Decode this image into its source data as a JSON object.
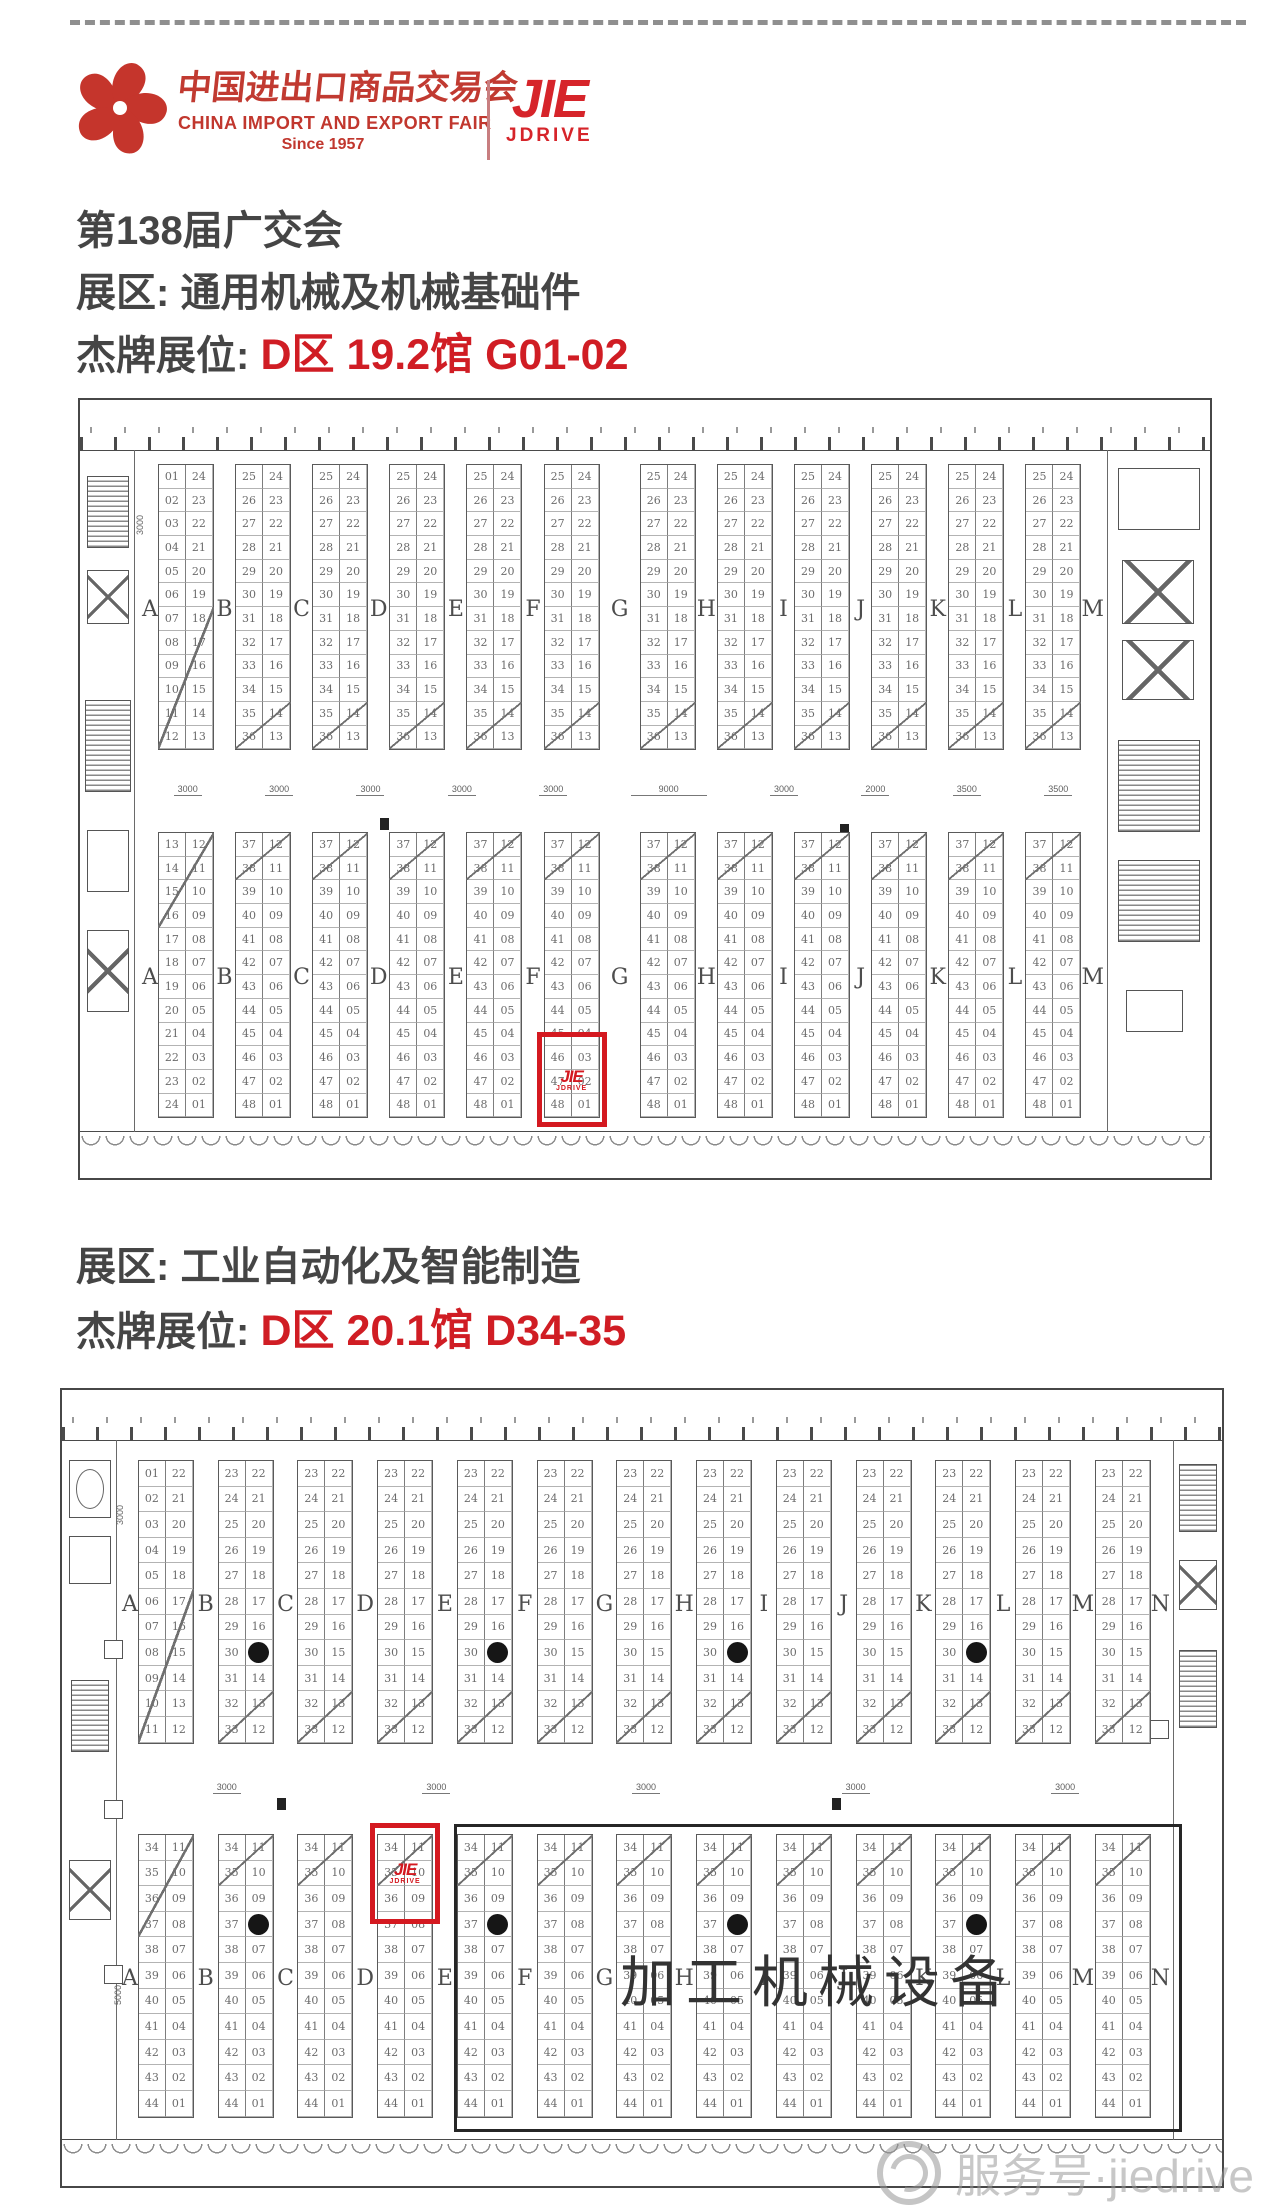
{
  "header": {
    "fair_logo": {
      "cn": "中国进出口商品交易会",
      "en": "CHINA IMPORT AND EXPORT FAIR",
      "since": "Since 1957",
      "color": "#c1372e"
    },
    "brand_logo": {
      "word": "JIE",
      "sub": "JDRIVE",
      "color": "#d6242a"
    }
  },
  "section1": {
    "line1": "第138届广交会",
    "line2_label": "展区:",
    "line2_value": "通用机械及机械基础件",
    "line3_label": "杰牌展位:",
    "line3_value": "D区 19.2馆 G01-02",
    "accent": "#d01d24"
  },
  "section2": {
    "line1_label": "展区:",
    "line1_value": "工业自动化及智能制造",
    "line2_label": "杰牌展位:",
    "line2_value": "D区 20.1馆 D34-35"
  },
  "watermark": {
    "text": "服务号·jiedrive"
  },
  "plans": {
    "hall1": {
      "blocks": 12,
      "rows": 12,
      "letters": [
        "A",
        "B",
        "C",
        "D",
        "E",
        "F",
        "G",
        "H",
        "I",
        "J",
        "K",
        "L",
        "M"
      ],
      "wide_letter": "G",
      "top": {
        "first_left": [
          1,
          12
        ],
        "first_right": [
          24,
          13
        ],
        "left": [
          25,
          36
        ],
        "right": [
          24,
          13
        ]
      },
      "bottom": {
        "first_left": [
          13,
          24
        ],
        "first_right": [
          12,
          1
        ],
        "left": [
          37,
          48
        ],
        "right": [
          12,
          1
        ]
      },
      "dims": [
        "3000",
        "3000",
        "3000",
        "3000",
        "3000",
        "9000",
        "3000",
        "2000",
        "3500",
        "3500"
      ],
      "side_dims": [
        "3000",
        "9000"
      ],
      "highlight": {
        "half": "bottom",
        "block_index": 5,
        "anchor": "bottom",
        "rows": 3
      }
    },
    "hall2": {
      "blocks": 13,
      "rows": 11,
      "letters": [
        "A",
        "B",
        "C",
        "D",
        "E",
        "F",
        "G",
        "H",
        "I",
        "J",
        "K",
        "L",
        "M",
        "N"
      ],
      "wide_letter": "",
      "top": {
        "first_left": [
          1,
          11
        ],
        "first_right": [
          22,
          12
        ],
        "left": [
          23,
          33
        ],
        "right": [
          22,
          12
        ]
      },
      "bottom": {
        "first_left": [
          34,
          44
        ],
        "first_right": [
          11,
          1
        ],
        "left": [
          34,
          44
        ],
        "right": [
          11,
          1
        ]
      },
      "dims": [
        "3000",
        "3000",
        "3000",
        "3000",
        "3000"
      ],
      "side_dims": [
        "3000",
        "5000"
      ],
      "pillars": {
        "top": {
          "blocks": [
            1,
            4,
            7,
            10
          ],
          "row": 7
        },
        "bottom": {
          "blocks": [
            1,
            4,
            7,
            10
          ],
          "row": 3
        }
      },
      "machine_zone_label": "加工机械设备",
      "highlight": {
        "half": "bottom",
        "block_index": 3,
        "anchor": "top",
        "rows": 3
      }
    }
  }
}
